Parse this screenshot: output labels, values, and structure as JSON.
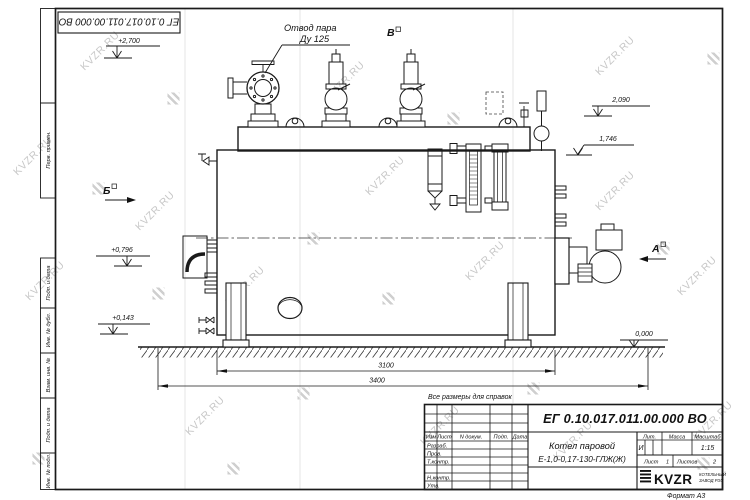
{
  "sheet": {
    "stamp_number": "ЕГ 0.10.017.011.00.000  ВО",
    "note_reference": "Все размеры для справок",
    "format_label": "Формат  А3"
  },
  "margin_fields": {
    "perv_primen": "Перв. примен.",
    "podp_data_1": "Подп. и дата",
    "inv_dubl": "Инв. № дубл.",
    "vzam_inv": "Взам. инв. №",
    "podp_data_2": "Подп. и дата",
    "inv_podl": "Инв. № подл."
  },
  "drawing": {
    "labels": {
      "steam_outlet_line1": "Отвод пара",
      "steam_outlet_line2": "Ду 125",
      "view_b": "Б",
      "view_v": "В",
      "view_a": "А"
    },
    "elevations": {
      "top": "+2,700",
      "e2090": "2,090",
      "e1746": "1,746",
      "e0796": "+0,796",
      "e0143": "+0,143",
      "zero": "0,000"
    },
    "dimensions": {
      "inner_length": "3100",
      "overall_length": "3400"
    }
  },
  "title_block": {
    "doc_number": "ЕГ 0.10.017.011.00.000  ВО",
    "name_line1": "Котел паровой",
    "name_line2": "Е-1,0-0,17-130-ГЛЖ(Ж)",
    "header": {
      "izm": "Изм",
      "list": "Лист",
      "n_doc": "N докум.",
      "podp": "Подп.",
      "data": "Дата"
    },
    "sign_rows": {
      "razrab": "Разраб.",
      "prov": "Пров.",
      "tkontr": "Т.контр.",
      "nkontr": "Н.контр.",
      "utv": "Утв."
    },
    "lit_header": "Лит.",
    "mass_header": "Масса",
    "scale_header": "Масштаб",
    "lit_value": "И",
    "scale_value": "1:15",
    "sheet_label": "Лист",
    "sheet_value": "1",
    "sheets_label": "Листов",
    "sheets_value": "2",
    "logo": {
      "text": "KVZR",
      "sub_line1": "КОТЕЛЬНЫЙ",
      "sub_line2": "ЗАВОД РЭУ"
    }
  },
  "watermark": {
    "text": "KVZR.RU"
  }
}
